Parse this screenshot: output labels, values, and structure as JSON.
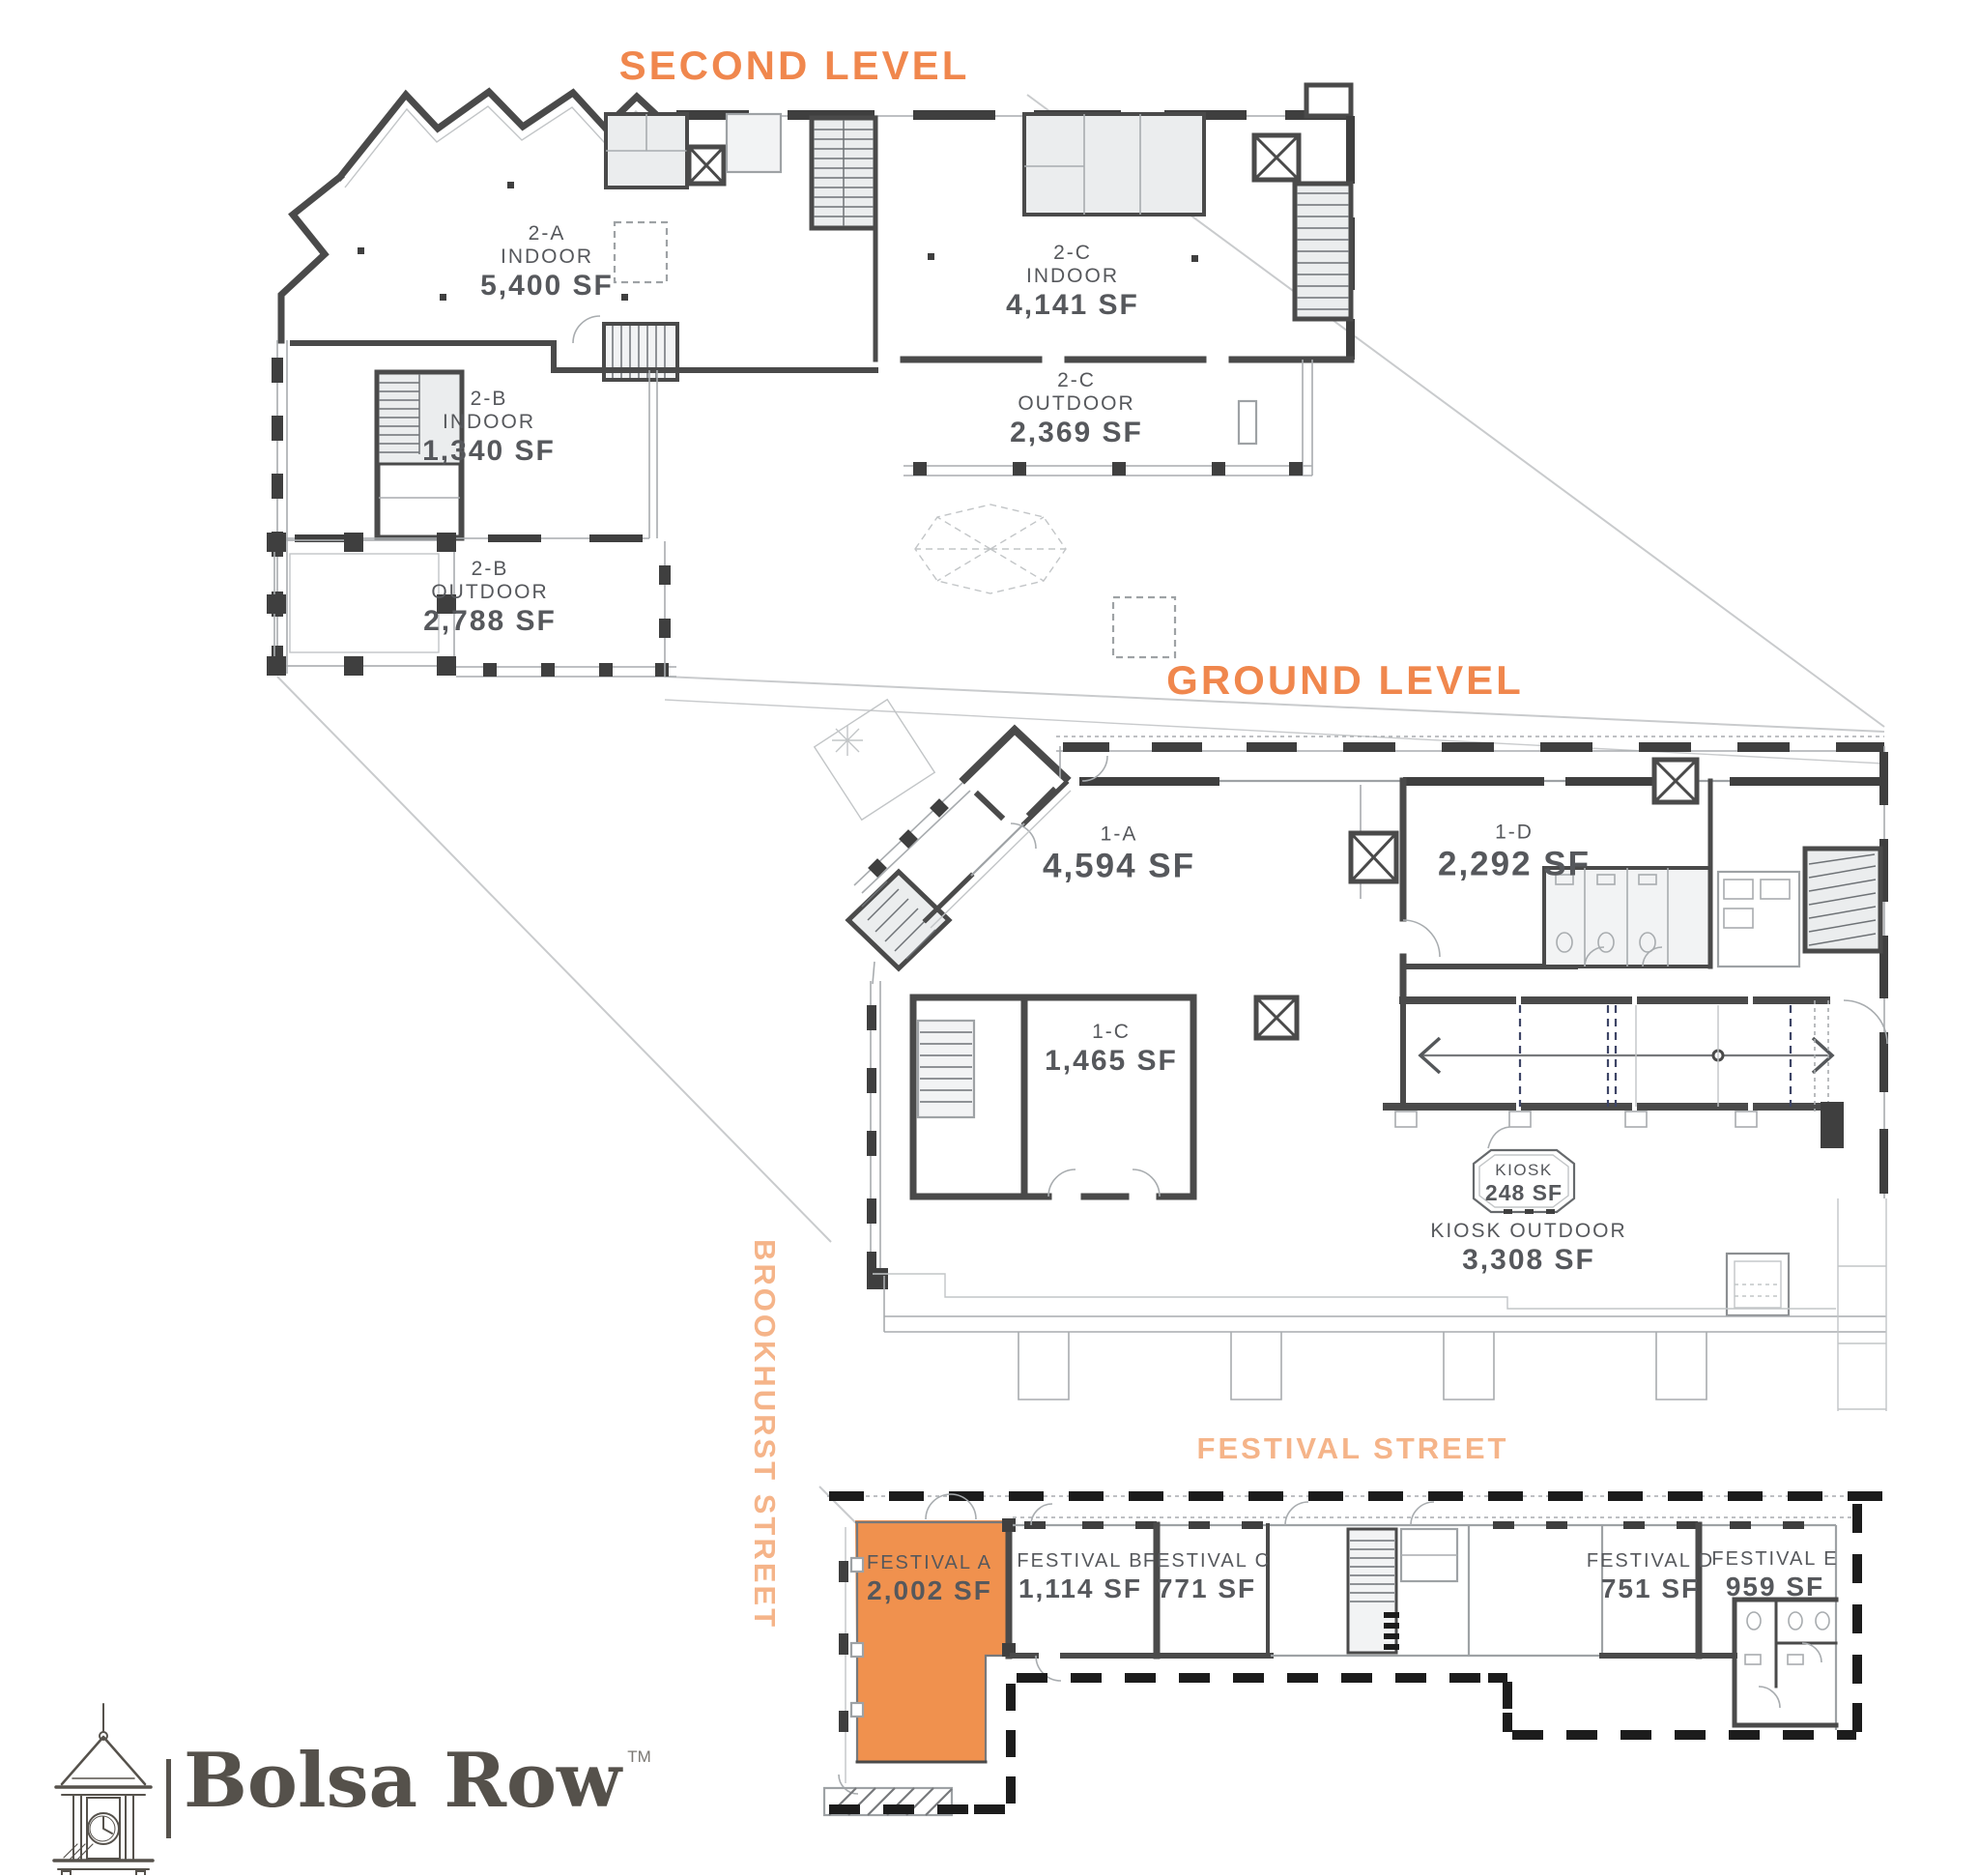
{
  "titles": {
    "second_level": "SECOND LEVEL",
    "ground_level": "GROUND LEVEL"
  },
  "streets": {
    "brookhurst": "BROOKHURST STREET",
    "festival": "FESTIVAL STREET"
  },
  "second_level": {
    "u2a": {
      "id": "2-A",
      "type": "INDOOR",
      "area": "5,400 SF"
    },
    "u2c_in": {
      "id": "2-C",
      "type": "INDOOR",
      "area": "4,141 SF"
    },
    "u2c_out": {
      "id": "2-C",
      "type": "OUTDOOR",
      "area": "2,369 SF"
    },
    "u2b_in": {
      "id": "2-B",
      "type": "INDOOR",
      "area": "1,340 SF"
    },
    "u2b_out": {
      "id": "2-B",
      "type": "OUTDOOR",
      "area": "2,788 SF"
    }
  },
  "ground_level": {
    "u1a": {
      "id": "1-A",
      "area": "4,594 SF"
    },
    "u1c": {
      "id": "1-C",
      "area": "1,465 SF"
    },
    "u1d": {
      "id": "1-D",
      "area": "2,292 SF"
    },
    "kiosk": {
      "id": "KIOSK",
      "area": "248 SF"
    },
    "kiosk_outdoor": {
      "id": "KIOSK OUTDOOR",
      "area": "3,308 SF"
    }
  },
  "festival": {
    "fa": {
      "id": "FESTIVAL A",
      "area": "2,002 SF"
    },
    "fb": {
      "id": "FESTIVAL B",
      "area": "1,114 SF"
    },
    "fc": {
      "id": "FESTIVAL C",
      "area": "771 SF"
    },
    "fd": {
      "id": "FESTIVAL D",
      "area": "751 SF"
    },
    "fe": {
      "id": "FESTIVAL E",
      "area": "959 SF"
    }
  },
  "brand": {
    "name": "Bolsa Row",
    "tm": "TM"
  },
  "colors": {
    "accent_orange": "#F0874D",
    "street_label_peach": "#F5B489",
    "highlight_fill": "#F0914E",
    "wall_dark": "#4A4A4A",
    "label_text": "#56585C",
    "logo_ink": "#55514B"
  }
}
